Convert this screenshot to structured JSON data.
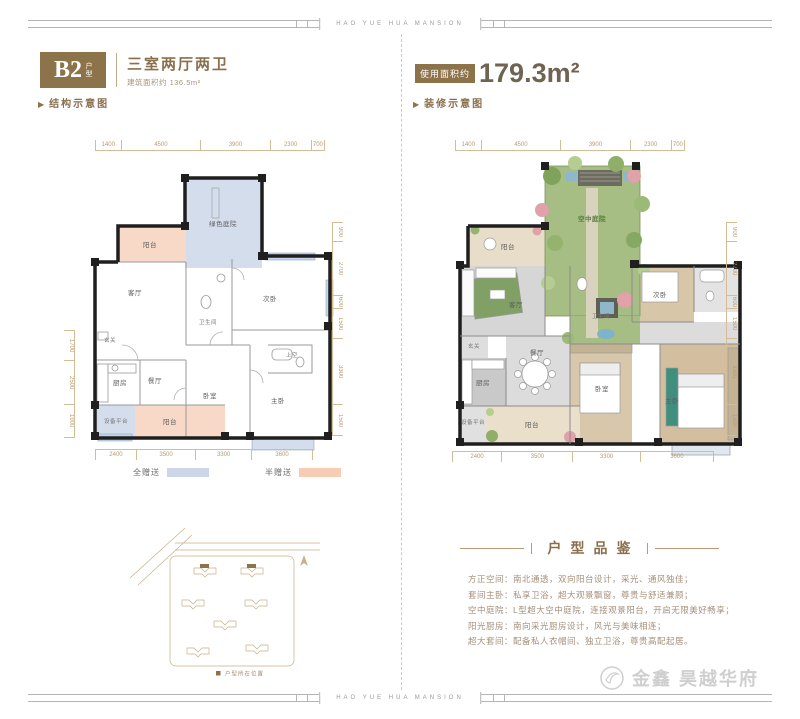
{
  "page": {
    "edge_text": "HAO YUE HUA MANSION"
  },
  "icons": {
    "pointer": "▶"
  },
  "colors": {
    "accent_brown": "#8d7349",
    "gift_full_blue": "#ccd6e8",
    "gift_half_pink": "#f6cdb2"
  },
  "left_panel": {
    "unit_code": "B2",
    "unit_type_suffix": "户型",
    "title": "三室两厅两卫",
    "area_note_label": "建筑面积约",
    "area_note_value": "136.5m²",
    "diagram_label": "结构示意图",
    "legend": [
      {
        "label": "全赠送",
        "color": "#ccd6e8"
      },
      {
        "label": "半赠送",
        "color": "#f6cdb2"
      }
    ],
    "plan": {
      "rooms": [
        "阳台",
        "绿色庭院",
        "客厅",
        "卫生间",
        "次卧",
        "玄关",
        "厨房",
        "餐厅",
        "卧室",
        "主卧",
        "上空",
        "设备平台",
        "阳台"
      ],
      "dims_top": [
        "1400",
        "4500",
        "3900",
        "2300",
        "700"
      ],
      "dims_bottom": [
        "2400",
        "3500",
        "3300",
        "3600"
      ],
      "dims_right": [
        "900",
        "2700",
        "600",
        "1500",
        "3300",
        "1500"
      ],
      "dims_left": [
        "1700",
        "2500",
        "1900"
      ]
    },
    "sitemap": {
      "legend_label": "户型所在位置"
    }
  },
  "right_panel": {
    "area_label": "使用面积约",
    "area_value": "179.3m²",
    "diagram_label": "装修示意图",
    "plan": {
      "rooms": [
        "阳台",
        "空中庭院",
        "客厅",
        "玄关",
        "厨房",
        "餐厅",
        "卫生间",
        "卧室",
        "次卧",
        "主卧",
        "设备平台",
        "阳台"
      ],
      "dims_top": [
        "1400",
        "4500",
        "3900",
        "2300",
        "700"
      ],
      "dims_bottom": [
        "2400",
        "3500",
        "3300",
        "3600"
      ],
      "dims_right": [
        "900",
        "2700",
        "600",
        "1500",
        "3300",
        "1500"
      ]
    },
    "section_title": "户型品鉴",
    "features": [
      "方正空间：南北通透，双向阳台设计，采光、通风独佳；",
      "套间主卧：私享卫浴，超大观景飘窗，尊贵与舒适兼顾；",
      "空中庭院：L型超大空中庭院，连接观景阳台，开启无限美好畅享；",
      "阳光厨房：南向采光厨房设计，风光与美味相连；",
      "超大套间：配备私人衣帽间、独立卫浴，尊贵高配起居。"
    ],
    "brand": "金鑫 昊越华府"
  }
}
